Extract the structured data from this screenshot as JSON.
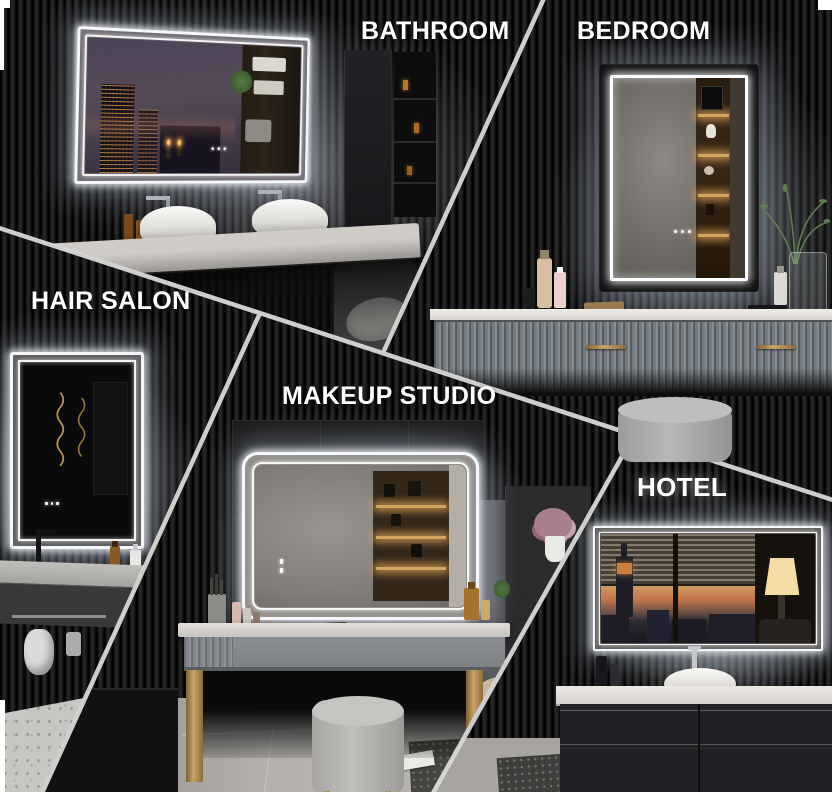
{
  "canvas": {
    "width": 832,
    "height": 798
  },
  "palette": {
    "wall_dark": "#121212",
    "divider_line": "#d6d6d4",
    "led_white": "#f4f8fc",
    "label_text": "#ffffff",
    "gold_accent": "#caa468",
    "counter_gray": "#c7c5c1",
    "floor_tile": "#b3b0ac"
  },
  "scenes": [
    {
      "id": "bathroom",
      "label": "BATHROOM",
      "objects": [
        "led-mirror-landscape",
        "city-night-reflection",
        "candles",
        "double-vessel-sinks",
        "floating-vanity",
        "wall-faucets",
        "towel-shelves"
      ]
    },
    {
      "id": "bedroom",
      "label": "BEDROOM",
      "objects": [
        "led-mirror-portrait",
        "warm-display-niche",
        "fluted-dresser",
        "perfume-bottles",
        "reed-diffuser-vase",
        "plant-sprigs"
      ]
    },
    {
      "id": "hair-salon",
      "label": "HAIR SALON",
      "objects": [
        "led-mirror-portrait",
        "gold-wall-sconces",
        "wash-basin",
        "black-faucet",
        "towel-rail",
        "hair-dryer",
        "terrazzo-floor"
      ]
    },
    {
      "id": "makeup-studio",
      "label": "MAKEUP STUDIO",
      "objects": [
        "led-mirror-rounded",
        "vanity-desk",
        "makeup-brushes",
        "cosmetics",
        "gray-pouf",
        "accent-chair",
        "area-rug",
        "flower-vase"
      ]
    },
    {
      "id": "hotel",
      "label": "HOTEL",
      "objects": [
        "led-mirror-landscape",
        "venetian-blinds",
        "city-sunset-skyline",
        "empire-state-silhouette",
        "table-lamp",
        "vessel-sink",
        "dark-credenza",
        "ottoman-pouf"
      ]
    }
  ]
}
